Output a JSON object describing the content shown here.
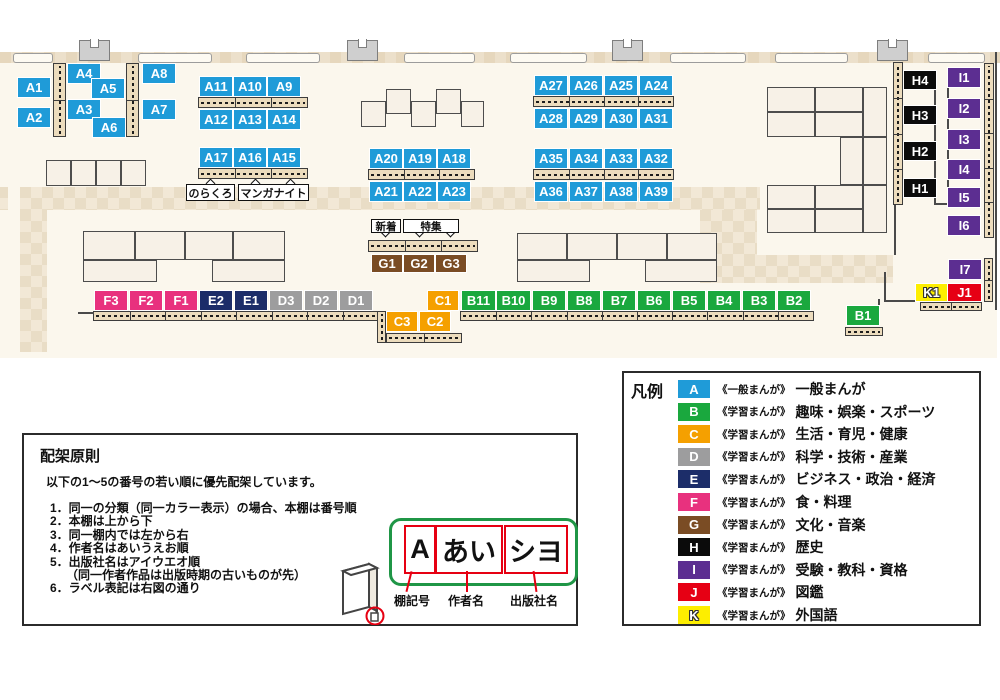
{
  "map": {
    "category_colors": {
      "A": "#1f9bd8",
      "B": "#1aa83e",
      "C": "#f5a000",
      "D": "#9d9d9e",
      "E": "#1c2d69",
      "F": "#e8317e",
      "G": "#7a4c24",
      "H": "#0b0b0b",
      "I": "#5c2e91",
      "J": "#e60014",
      "K": "#fdee00"
    },
    "labels": [
      {
        "id": "A1",
        "x": 18,
        "y": 78
      },
      {
        "id": "A2",
        "x": 18,
        "y": 108
      },
      {
        "id": "A4",
        "x": 68,
        "y": 64
      },
      {
        "id": "A5",
        "x": 92,
        "y": 79
      },
      {
        "id": "A3",
        "x": 68,
        "y": 100
      },
      {
        "id": "A6",
        "x": 93,
        "y": 118
      },
      {
        "id": "A8",
        "x": 143,
        "y": 64
      },
      {
        "id": "A7",
        "x": 143,
        "y": 100
      },
      {
        "id": "A11",
        "x": 200,
        "y": 77
      },
      {
        "id": "A10",
        "x": 234,
        "y": 77
      },
      {
        "id": "A9",
        "x": 268,
        "y": 77
      },
      {
        "id": "A12",
        "x": 200,
        "y": 110
      },
      {
        "id": "A13",
        "x": 234,
        "y": 110
      },
      {
        "id": "A14",
        "x": 268,
        "y": 110
      },
      {
        "id": "A17",
        "x": 200,
        "y": 148
      },
      {
        "id": "A16",
        "x": 234,
        "y": 148
      },
      {
        "id": "A15",
        "x": 268,
        "y": 148
      },
      {
        "id": "A20",
        "x": 370,
        "y": 149
      },
      {
        "id": "A19",
        "x": 404,
        "y": 149
      },
      {
        "id": "A18",
        "x": 438,
        "y": 149
      },
      {
        "id": "A21",
        "x": 370,
        "y": 182
      },
      {
        "id": "A22",
        "x": 404,
        "y": 182
      },
      {
        "id": "A23",
        "x": 438,
        "y": 182
      },
      {
        "id": "A27",
        "x": 535,
        "y": 76
      },
      {
        "id": "A26",
        "x": 570,
        "y": 76
      },
      {
        "id": "A25",
        "x": 605,
        "y": 76
      },
      {
        "id": "A24",
        "x": 640,
        "y": 76
      },
      {
        "id": "A28",
        "x": 535,
        "y": 109
      },
      {
        "id": "A29",
        "x": 570,
        "y": 109
      },
      {
        "id": "A30",
        "x": 605,
        "y": 109
      },
      {
        "id": "A31",
        "x": 640,
        "y": 109
      },
      {
        "id": "A35",
        "x": 535,
        "y": 149
      },
      {
        "id": "A34",
        "x": 570,
        "y": 149
      },
      {
        "id": "A33",
        "x": 605,
        "y": 149
      },
      {
        "id": "A32",
        "x": 640,
        "y": 149
      },
      {
        "id": "A36",
        "x": 535,
        "y": 182
      },
      {
        "id": "A37",
        "x": 570,
        "y": 182
      },
      {
        "id": "A38",
        "x": 605,
        "y": 182
      },
      {
        "id": "A39",
        "x": 640,
        "y": 182
      },
      {
        "id": "G1",
        "x": 372,
        "y": 255,
        "w": 30,
        "h": 17
      },
      {
        "id": "G2",
        "x": 404,
        "y": 255,
        "w": 30,
        "h": 17
      },
      {
        "id": "G3",
        "x": 436,
        "y": 255,
        "w": 30,
        "h": 17
      },
      {
        "id": "F3",
        "x": 95,
        "y": 291
      },
      {
        "id": "F2",
        "x": 130,
        "y": 291
      },
      {
        "id": "F1",
        "x": 165,
        "y": 291
      },
      {
        "id": "E2",
        "x": 200,
        "y": 291
      },
      {
        "id": "E1",
        "x": 235,
        "y": 291
      },
      {
        "id": "D3",
        "x": 270,
        "y": 291
      },
      {
        "id": "D2",
        "x": 305,
        "y": 291
      },
      {
        "id": "D1",
        "x": 340,
        "y": 291
      },
      {
        "id": "C1",
        "x": 428,
        "y": 291,
        "w": 30
      },
      {
        "id": "C3",
        "x": 387,
        "y": 312,
        "w": 30
      },
      {
        "id": "C2",
        "x": 420,
        "y": 312,
        "w": 30
      },
      {
        "id": "B11",
        "x": 462,
        "y": 291,
        "w": 33
      },
      {
        "id": "B10",
        "x": 497,
        "y": 291,
        "w": 33
      },
      {
        "id": "B9",
        "x": 533,
        "y": 291
      },
      {
        "id": "B8",
        "x": 568,
        "y": 291
      },
      {
        "id": "B7",
        "x": 603,
        "y": 291
      },
      {
        "id": "B6",
        "x": 638,
        "y": 291
      },
      {
        "id": "B5",
        "x": 673,
        "y": 291
      },
      {
        "id": "B4",
        "x": 708,
        "y": 291
      },
      {
        "id": "B3",
        "x": 743,
        "y": 291
      },
      {
        "id": "B2",
        "x": 778,
        "y": 291
      },
      {
        "id": "B1",
        "x": 847,
        "y": 306
      },
      {
        "id": "H4",
        "x": 904,
        "y": 71,
        "h": 18
      },
      {
        "id": "H3",
        "x": 904,
        "y": 106,
        "h": 18
      },
      {
        "id": "H2",
        "x": 904,
        "y": 142,
        "h": 18
      },
      {
        "id": "H1",
        "x": 904,
        "y": 179,
        "h": 18
      },
      {
        "id": "I1",
        "x": 948,
        "y": 68
      },
      {
        "id": "I2",
        "x": 948,
        "y": 99
      },
      {
        "id": "I3",
        "x": 948,
        "y": 130
      },
      {
        "id": "I4",
        "x": 948,
        "y": 160
      },
      {
        "id": "I5",
        "x": 948,
        "y": 188
      },
      {
        "id": "I6",
        "x": 948,
        "y": 216
      },
      {
        "id": "I7",
        "x": 949,
        "y": 260
      },
      {
        "id": "K1",
        "x": 916,
        "y": 284,
        "w": 31,
        "h": 17
      },
      {
        "id": "J1",
        "x": 948,
        "y": 284,
        "w": 33,
        "h": 17
      }
    ],
    "callouts": [
      {
        "text": "のらくろ",
        "x": 186,
        "y": 184,
        "w": 49,
        "h": 17,
        "dir": "up",
        "pointers": [
          207
        ],
        "fs": 11
      },
      {
        "text": "マンガナイト",
        "x": 238,
        "y": 184,
        "w": 71,
        "h": 17,
        "dir": "up",
        "pointers": [
          252,
          287
        ],
        "fs": 11
      },
      {
        "text": "新着",
        "x": 371,
        "y": 219,
        "w": 30,
        "h": 14,
        "dir": "down",
        "pointers": [
          382
        ],
        "fs": 10.5
      },
      {
        "text": "特集",
        "x": 403,
        "y": 219,
        "w": 56,
        "h": 14,
        "dir": "down",
        "pointers": [
          416,
          447
        ],
        "fs": 10.5
      }
    ]
  },
  "legend": {
    "title": "凡例",
    "items": [
      {
        "code": "A",
        "type": "《一般まんが》",
        "label": "一般まんが"
      },
      {
        "code": "B",
        "type": "《学習まんが》",
        "label": "趣味・娯楽・スポーツ"
      },
      {
        "code": "C",
        "type": "《学習まんが》",
        "label": "生活・育児・健康"
      },
      {
        "code": "D",
        "type": "《学習まんが》",
        "label": "科学・技術・産業"
      },
      {
        "code": "E",
        "type": "《学習まんが》",
        "label": "ビジネス・政治・経済"
      },
      {
        "code": "F",
        "type": "《学習まんが》",
        "label": "食・料理"
      },
      {
        "code": "G",
        "type": "《学習まんが》",
        "label": "文化・音楽"
      },
      {
        "code": "H",
        "type": "《学習まんが》",
        "label": "歴史"
      },
      {
        "code": "I",
        "type": "《学習まんが》",
        "label": "受験・教科・資格"
      },
      {
        "code": "J",
        "type": "《学習まんが》",
        "label": "図鑑"
      },
      {
        "code": "K",
        "type": "《学習まんが》",
        "label": "外国語"
      }
    ]
  },
  "principles": {
    "title": "配架原則",
    "intro": "以下の1～5の番号の若い順に優先配架しています。",
    "items": [
      {
        "text": "1．同一の分類（同一カラー表示）の場合、本棚は番号順"
      },
      {
        "text": "2．本棚は上から下"
      },
      {
        "text": "3．同一棚内では左から右"
      },
      {
        "text": "4．作者名はあいうえお順"
      },
      {
        "text": "5．出版社名はアイウエオ順"
      },
      {
        "text": "（同一作者作品は出版時期の古いものが先）",
        "indent": true
      },
      {
        "text": "6．ラベル表記は右図の通り"
      }
    ],
    "label_diagram": {
      "boxes": [
        {
          "text": "A",
          "caption": "棚記号"
        },
        {
          "text": "あい",
          "caption": "作者名"
        },
        {
          "text": "シヨ",
          "caption": "出版社名"
        }
      ]
    }
  }
}
